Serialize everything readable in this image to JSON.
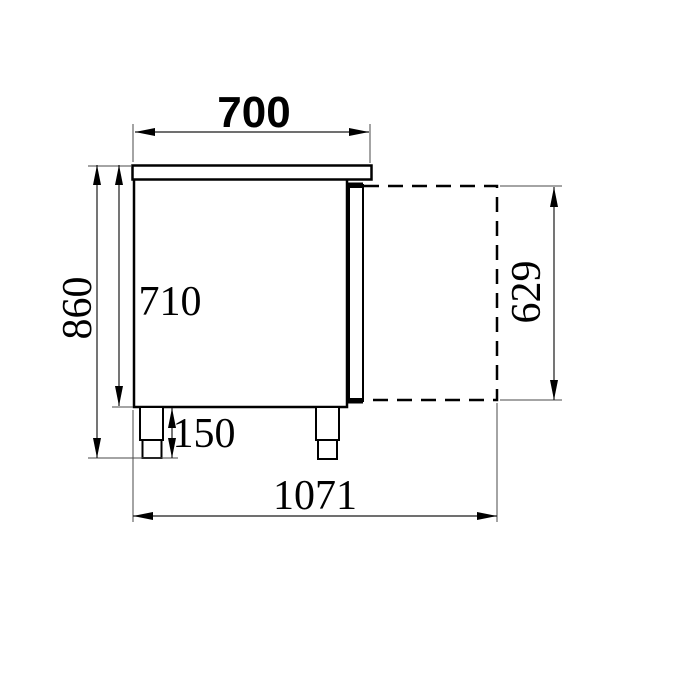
{
  "drawing": {
    "background_color": "#ffffff",
    "line_color": "#000000",
    "description": "side-view dimensional drawing of refrigerated counter with open door projection",
    "labels": {
      "width_top": "700",
      "height_overall": "860",
      "height_body": "710",
      "leg_height": "150",
      "door_open_height": "629",
      "depth_overall": "1071"
    }
  }
}
